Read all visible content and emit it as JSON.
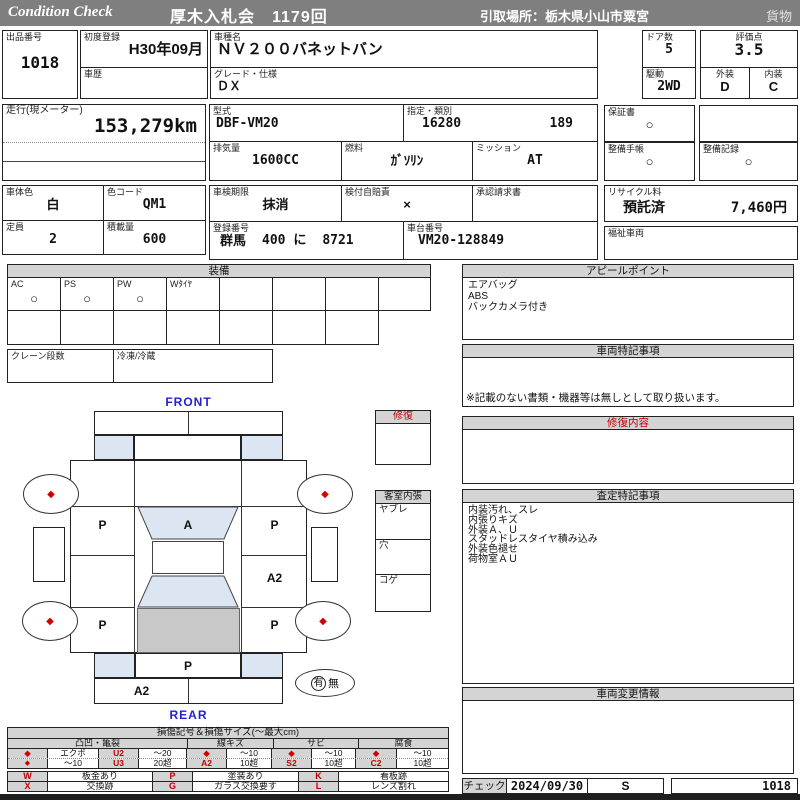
{
  "colors": {
    "header_bg": "#7f7f7f",
    "section_header_bg": "#d4d4d4",
    "accent_red": "#c00000",
    "accent_blue": "#2222cc",
    "window_blue": "#dce6f2",
    "roof_gray": "#c8c8c8"
  },
  "header": {
    "brand": "Condition Check",
    "title": "厚木入札会　1179回",
    "pickup": "引取場所：栃木県小山市粟宮",
    "category": "貨物"
  },
  "fields": {
    "lot": {
      "label": "出品番号",
      "value": "1018"
    },
    "first_reg": {
      "label": "初度登録",
      "value": "H30年09月"
    },
    "history": {
      "label": "車歴",
      "value": ""
    },
    "model_name": {
      "label": "車種名",
      "value": "ＮＶ２００バネットバン"
    },
    "grade": {
      "label": "グレード・仕様",
      "value": "ＤＸ"
    },
    "doors": {
      "label": "ドア数",
      "value": "5"
    },
    "drive": {
      "label": "駆動",
      "value": "2WD"
    },
    "score": {
      "label": "評価点",
      "value": "3.5"
    },
    "exterior": {
      "label": "外装",
      "value": "D"
    },
    "interior": {
      "label": "内装",
      "value": "C"
    },
    "mileage": {
      "label": "走行(現メーター)",
      "value": "153,279km"
    },
    "model_code": {
      "label": "型式",
      "value": "DBF-VM20"
    },
    "type_class": {
      "label": "指定・類別",
      "type_no": "16280",
      "class_no": "189"
    },
    "warranty": {
      "label": "保証書",
      "value": "○"
    },
    "displacement": {
      "label": "排気量",
      "value": "1600CC"
    },
    "fuel": {
      "label": "燃料",
      "value": "ｶﾞｿﾘﾝ"
    },
    "mission": {
      "label": "ミッション",
      "value": "AT"
    },
    "maintenance_book": {
      "label": "整備手帳",
      "value": "○"
    },
    "maintenance_record": {
      "label": "整備記録",
      "value": "○"
    },
    "body_color": {
      "label": "車体色",
      "value": "白"
    },
    "color_code": {
      "label": "色コード",
      "value": "QM1"
    },
    "inspection": {
      "label": "車検期限",
      "value": "抹消"
    },
    "insurance": {
      "label": "検付自賠責",
      "value": "×"
    },
    "approval": {
      "label": "承認請求書",
      "value": ""
    },
    "recycle": {
      "label": "リサイクル料",
      "status": "預託済",
      "fee": "7,460円"
    },
    "capacity": {
      "label": "定員",
      "value": "2"
    },
    "payload": {
      "label": "積載量",
      "value": "600"
    },
    "registration": {
      "label": "登録番号",
      "area": "群馬",
      "cls": "400 に",
      "number": "8721"
    },
    "chassis": {
      "label": "車台番号",
      "value": "VM20-128849"
    },
    "welfare": {
      "label": "福祉車両",
      "value": ""
    }
  },
  "equipment": {
    "title": "装備",
    "items": [
      {
        "label": "AC",
        "value": "○"
      },
      {
        "label": "PS",
        "value": "○"
      },
      {
        "label": "PW",
        "value": "○"
      },
      {
        "label": "Wﾀｲﾔ",
        "value": ""
      }
    ],
    "crane_label": "クレーン段数",
    "refrigeration_label": "冷凍/冷蔵"
  },
  "appeal": {
    "title": "アピールポイント",
    "lines": [
      "エアバッグ",
      "ABS",
      "バックカメラ付き"
    ]
  },
  "vehicle_notes": {
    "title": "車両特記事項",
    "disclaimer": "※記載のない書類・機器等は無しとして取り扱います。"
  },
  "repair_details": {
    "title": "修復内容"
  },
  "assessment": {
    "title": "査定特記事項",
    "lines": [
      "内装汚れ、スレ",
      "内張りキズ",
      "外装Ａ、Ｕ",
      "スタッドレスタイヤ積み込み",
      "外装色褪せ",
      "荷物室ＡＵ"
    ]
  },
  "change_info": {
    "title": "車両変更情報"
  },
  "diagram": {
    "front_label": "FRONT",
    "rear_label": "REAR",
    "marks": {
      "fl_door": "P",
      "windshield": "A",
      "fr_door": "P",
      "right_slide": "A2",
      "rl_quarter": "P",
      "rr_quarter": "P",
      "rear_gate": "P",
      "rear_bumper": "A2"
    },
    "wheel_mark": "◆",
    "spare": {
      "yes": "有",
      "no": "無"
    },
    "repair_flag": {
      "title": "修復"
    },
    "cabin_lining": {
      "title": "客室内張",
      "rows": [
        "ヤブレ",
        "穴",
        "コゲ"
      ]
    }
  },
  "legend": {
    "title": "損傷記号＆損傷サイズ(〜最大cm)",
    "groups": [
      "凸凹・亀裂",
      "線キズ",
      "サビ",
      "腐食"
    ],
    "cells": {
      "dent_r1": [
        "◆",
        "エクボ",
        "U2",
        "〜20"
      ],
      "dent_r2": [
        "◆",
        "〜10",
        "U3",
        "20超"
      ],
      "line_r1": [
        "◆",
        "〜10"
      ],
      "line_r2": [
        "A2",
        "10超"
      ],
      "rust_r1": [
        "◆",
        "〜10"
      ],
      "rust_r2": [
        "S2",
        "10超"
      ],
      "corr_r1": [
        "◆",
        "〜10"
      ],
      "corr_r2": [
        "C2",
        "10超"
      ]
    },
    "codes": [
      {
        "c": "W",
        "d": "板金あり"
      },
      {
        "c": "P",
        "d": "塗装あり"
      },
      {
        "c": "K",
        "d": "看板跡"
      },
      {
        "c": "X",
        "d": "交換跡"
      },
      {
        "c": "G",
        "d": "ガラス交換要す"
      },
      {
        "c": "L",
        "d": "レンズ割れ"
      }
    ]
  },
  "check_row": {
    "label": "チェック",
    "date": "2024/09/30",
    "inspector": "S",
    "lot_no": "1018"
  }
}
